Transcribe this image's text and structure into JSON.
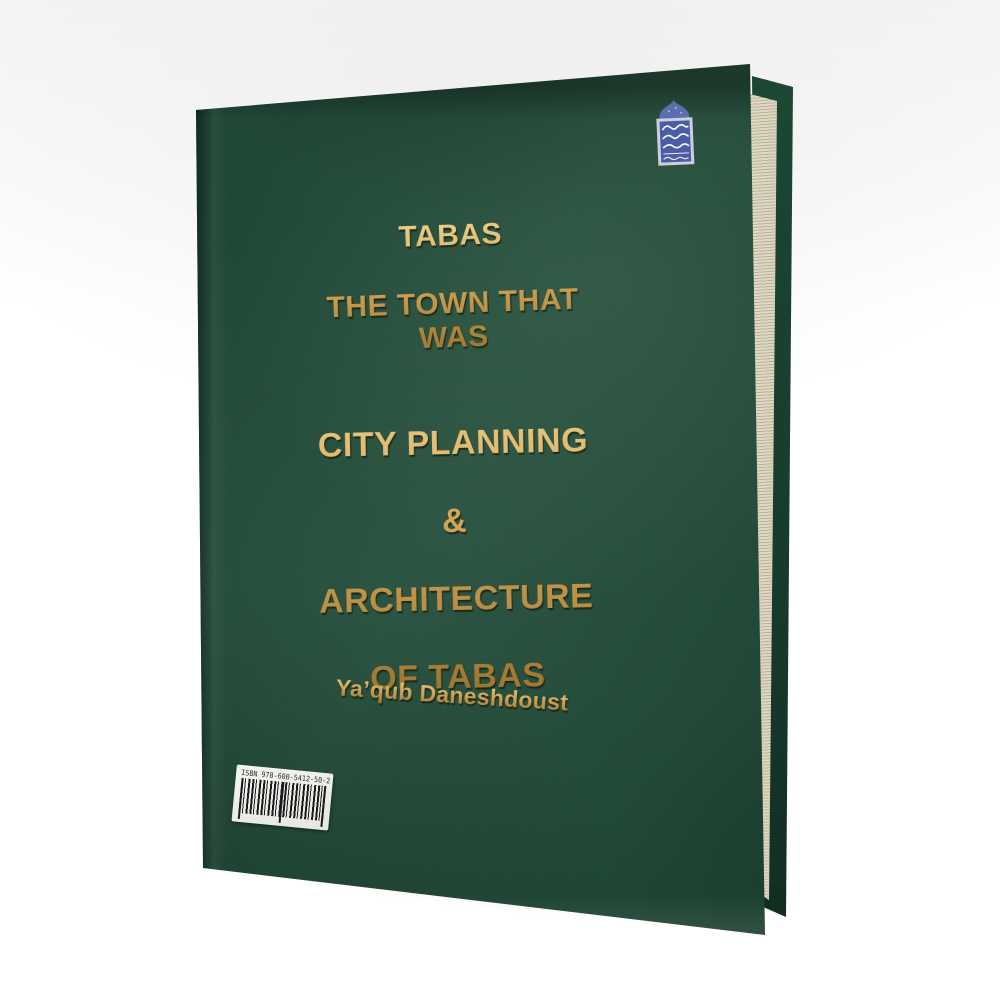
{
  "photo": {
    "background_color": "#f4f4f4"
  },
  "book": {
    "cover_color": "#265340",
    "gold_color": "#c99a48",
    "pages_color": "#ece6d4",
    "top_title": {
      "line1": "TABAS",
      "line2": "THE TOWN THAT WAS"
    },
    "center_title": {
      "line1": "CITY PLANNING",
      "line2": "&",
      "line3": "ARCHITECTURE",
      "line4": "OF TABAS"
    },
    "author": "Ya’qub Daneshdoust",
    "barcode": {
      "isbn": "ISBN 978-600-5412-50-2"
    },
    "emblem": {
      "icon": "mosque-dome-publisher-emblem",
      "blue": "#4a5ca6",
      "frame": "#ccd0da"
    }
  }
}
